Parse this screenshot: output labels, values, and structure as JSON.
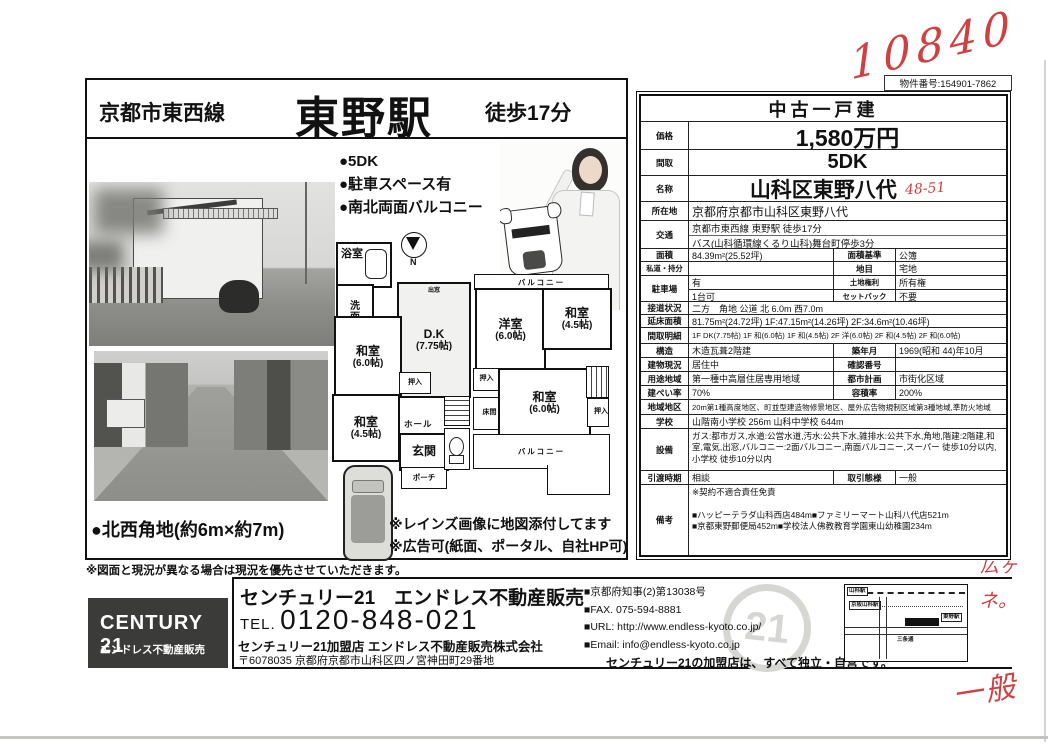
{
  "scan": {
    "top_number": "10840",
    "side_note_1": "広ヶ",
    "side_note_2": "ネ。",
    "side_note_3": "一般"
  },
  "property_number": "物件番号:154901-7862",
  "header": {
    "line_name": "京都市東西線",
    "station": "東野駅",
    "walk": "徒歩17分"
  },
  "features": [
    "●5DK",
    "●駐車スペース有",
    "●南北両面バルコニー"
  ],
  "corner_note": "●北西角地(約6m×約7m)",
  "ad_notes": [
    "※レインズ画像に地図添付してます",
    "※広告可(紙面、ポータル、自社HP可)"
  ],
  "disclaimer": "※図面と現況が異なる場合は現況を優先させていただきます。",
  "floorplan": {
    "compass": "N",
    "f1": {
      "bath": "浴室",
      "wash": "洗面所",
      "dk": "D.K",
      "dk_size": "(7.75帖)",
      "bay_window": "出窓",
      "washitsu6": "和室",
      "washitsu6_size": "(6.0帖)",
      "oshiire": "押入",
      "washitsu45": "和室",
      "washitsu45_size": "(4.5帖)",
      "hall": "ホール",
      "entrance": "玄関",
      "porch": "ポーチ"
    },
    "f2": {
      "balcony_n": "バルコニー",
      "yoshitsu": "洋室",
      "yoshitsu_size": "(6.0帖)",
      "washitsu45": "和室",
      "washitsu45_size": "(4.5帖)",
      "oshiire_l": "押入",
      "tokonoma": "床間",
      "washitsu6": "和室",
      "washitsu6_size": "(6.0帖)",
      "oshiire_r": "押入",
      "balcony_s": "バルコニー"
    }
  },
  "table": {
    "rows": [
      {
        "type": "title",
        "h": 26,
        "value": "中古一戸建"
      },
      {
        "type": "big",
        "h": 28,
        "label": "価格",
        "value": "1,580万円",
        "vsize": 23
      },
      {
        "type": "big",
        "h": 26,
        "label": "間取",
        "value": "5DK",
        "vsize": 20
      },
      {
        "type": "big",
        "h": 26,
        "label": "名称",
        "value": "山科区東野八代",
        "vsize": 21,
        "note": "48-51"
      },
      {
        "type": "single",
        "h": 19,
        "label": "所在地",
        "value": "京都府京都市山科区東野八代",
        "big": true
      },
      {
        "type": "two",
        "h": 28,
        "label": "交通",
        "lines": [
          "京都市東西線 東野駅 徒歩17分",
          "バス(山科循環線くるり山科)舞台町停歩3分"
        ]
      },
      {
        "type": "quad",
        "h": 13,
        "label": "面積",
        "value": "84.39m²(25.52坪)",
        "label2": "面積基準",
        "value2": "公簿"
      },
      {
        "type": "quad",
        "h": 14,
        "label": "私道・持分",
        "value": "",
        "label2": "地目",
        "value2": "宅地"
      },
      {
        "type": "park",
        "h": 26,
        "label": "駐車場",
        "v1": "有",
        "l1": "土地権利",
        "r1": "所有権",
        "v2": "1台可",
        "l2": "セットバック",
        "r2": "不要"
      },
      {
        "type": "single",
        "h": 13,
        "label": "接道状況",
        "value": "二方　角地 公道 北 6.0m 西7.0m"
      },
      {
        "type": "single",
        "h": 13,
        "label": "延床面積",
        "value": "81.75m²(24.72坪) 1F:47.15m²(14.26坪) 2F:34.6m²(10.46坪)"
      },
      {
        "type": "single",
        "h": 16,
        "label": "間取明細",
        "value": "1F DK(7.75帖) 1F 和(6.0帖) 1F 和(4.5帖) 2F 洋(6.0帖) 2F 和(4.5帖) 2F 和(6.0帖)",
        "small": true
      },
      {
        "type": "quad",
        "h": 14,
        "label": "構造",
        "value": "木造瓦葺2階建",
        "label2": "築年月",
        "value2": "1969(昭和 44)年10月"
      },
      {
        "type": "quad",
        "h": 14,
        "label": "建物現況",
        "value": "居住中",
        "label2": "確認番号",
        "value2": ""
      },
      {
        "type": "quad",
        "h": 14,
        "label": "用途地域",
        "value": "第一種中高層住居専用地域",
        "label2": "都市計画",
        "value2": "市街化区域"
      },
      {
        "type": "quad",
        "h": 14,
        "label": "建ぺい率",
        "value": "70%",
        "label2": "容積率",
        "value2": "200%"
      },
      {
        "type": "single",
        "h": 15,
        "label": "地域地区",
        "value": "20m第1種高度地区、町並型建造物修景地区、屋外広告物規制区域第3種地域,準防火地域",
        "small": true
      },
      {
        "type": "single",
        "h": 14,
        "label": "学校",
        "value": "山階南小学校 256m 山科中学校 644m"
      },
      {
        "type": "tall",
        "h": 42,
        "label": "設備",
        "value": "ガス:都市ガス,水道:公営水道,汚水:公共下水,雑排水:公共下水,角地,階建:2階建,和室,電気,出窓,バルコニー:2面バルコニー,南面バルコニー,スーパー 徒歩10分以内,小学校 徒歩10分以内"
      },
      {
        "type": "quad",
        "h": 14,
        "label": "引渡時期",
        "value": "相談",
        "label2": "取引態様",
        "value2": "一般"
      },
      {
        "type": "tall",
        "h": 70,
        "label": "備考",
        "value": "※契約不適合責任免責\n\n■ハッピーテラダ山科西店484m■ファミリーマート山科八代店521m\n■京都東野郵便局452m■学校法人佛教教育学園東山幼稚園234m"
      }
    ]
  },
  "footer": {
    "logo_line1": "CENTURY 21",
    "logo_line2": "エンドレス不動産販売",
    "agency_name": "センチュリー21　エンドレス不動産販売",
    "tel_label": "TEL.",
    "tel_number": "0120-848-021",
    "member_line": "センチュリー21加盟店 エンドレス不動産販売株式会社",
    "address_line": "〒6078035 京都府京都市山科区四ノ宮神田町29番地",
    "license_lines": [
      "■京都府知事(2)第13038号",
      "■FAX. 075-594-8881",
      "■URL: http://www.endless-kyoto.co.jp/",
      "■Email: info@endless-kyoto.co.jp"
    ],
    "independent_note": "センチュリー21の加盟店は、すべて独立・自営です。",
    "seal_number": "21",
    "map": {
      "station1": "山科駅",
      "station2": "京阪山科駅",
      "station3": "東野駅",
      "road": "三条通"
    }
  },
  "colors": {
    "handwriting": "#cf4040",
    "logo_bg": "#3b3b39",
    "border": "#1a1a1a"
  }
}
